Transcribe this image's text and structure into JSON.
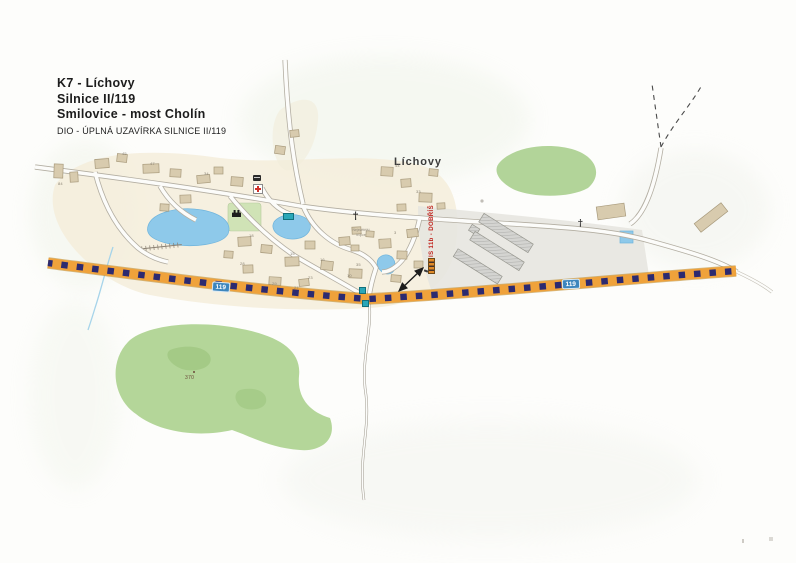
{
  "document": {
    "type": "scanned traffic-detour map page",
    "title_block": {
      "line1": "K7 - Líchovy",
      "line2": "Silnice II/119",
      "line3": "Smilovice - most Cholín",
      "line4": "DIO - ÚPLNÁ UZAVÍRKA SILNICE II/119"
    }
  },
  "map": {
    "village_label": "Líchovy",
    "detour_sign_label": "IS 11b - DOBŘÍŠ",
    "road_badge_left": "119",
    "road_badge_right": "119",
    "elevation_point": "370",
    "chapel_label": {
      "line1": "Nejsvětější",
      "line2": "trojice"
    },
    "house_numbers": [
      "84",
      "45",
      "47",
      "34",
      "44",
      "33",
      "18",
      "15",
      "16",
      "28",
      "23",
      "29",
      "27",
      "10",
      "35",
      "3"
    ],
    "icons": {
      "closure_line": "orange-black dashed full-closure band over silnice II/119",
      "barrier_icon": "striped road-closure barrier symbol",
      "arrow_icon": "double-headed pointer from closure line to barrier sign",
      "church_cross_icon": "†",
      "wayside_cross_icon": "†",
      "medical_cross_icon": "red cross on white",
      "park_building_icon": "black chapel/monument pictogram",
      "bus_stop_markers": "small teal roadside sign marks"
    },
    "colors": {
      "closure_orange": "#efa23b",
      "closure_navy": "#2c2a70",
      "badge_blue": "#3d86bd",
      "water": "#8ec9ea",
      "forest": "#b0d494",
      "village_fill": "#f4edda",
      "building_fill": "#d8cbae",
      "detour_text_red": "#c0241e"
    }
  }
}
